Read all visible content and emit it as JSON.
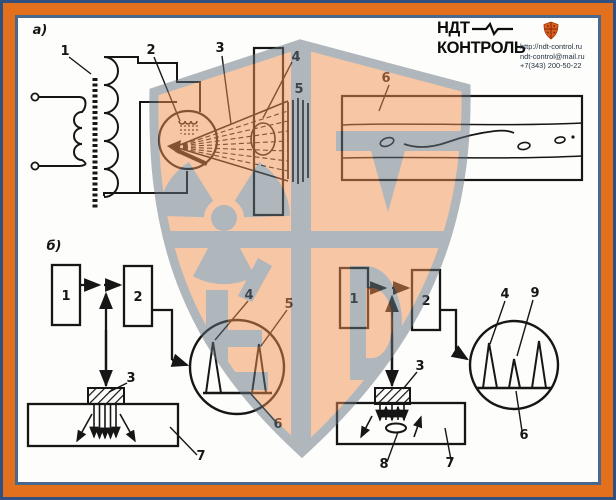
{
  "header": {
    "brand_line1": "НДТ",
    "brand_line2": "КОНТРОЛЬ",
    "website": "http://ndt-control.ru",
    "email": "ndt-control@mail.ru",
    "phone": "+7(343) 200-50-22"
  },
  "colors": {
    "frame_orange": "#e2701c",
    "frame_navy": "#30517f",
    "frame_steel": "#49688f",
    "watermark_peach": "#f09051",
    "watermark_gray": "#65737e",
    "ink": "#161616"
  },
  "labels": {
    "a_section": "а)",
    "a1": "1",
    "a2": "2",
    "a3": "3",
    "a4": "4",
    "a5": "5",
    "a6": "6",
    "b_section": "б)",
    "bl_block1": "1",
    "bl_block2": "2",
    "bl_probe": "3",
    "bl_peak1": "4",
    "bl_peak2": "5",
    "bl_screen": "6",
    "bl_specimen": "7",
    "br_block1": "1",
    "br_block2": "2",
    "br_probe": "3",
    "br_peak1": "4",
    "br_peak2": "9",
    "br_screen": "6",
    "br_specimen": "7",
    "br_defect": "8"
  }
}
